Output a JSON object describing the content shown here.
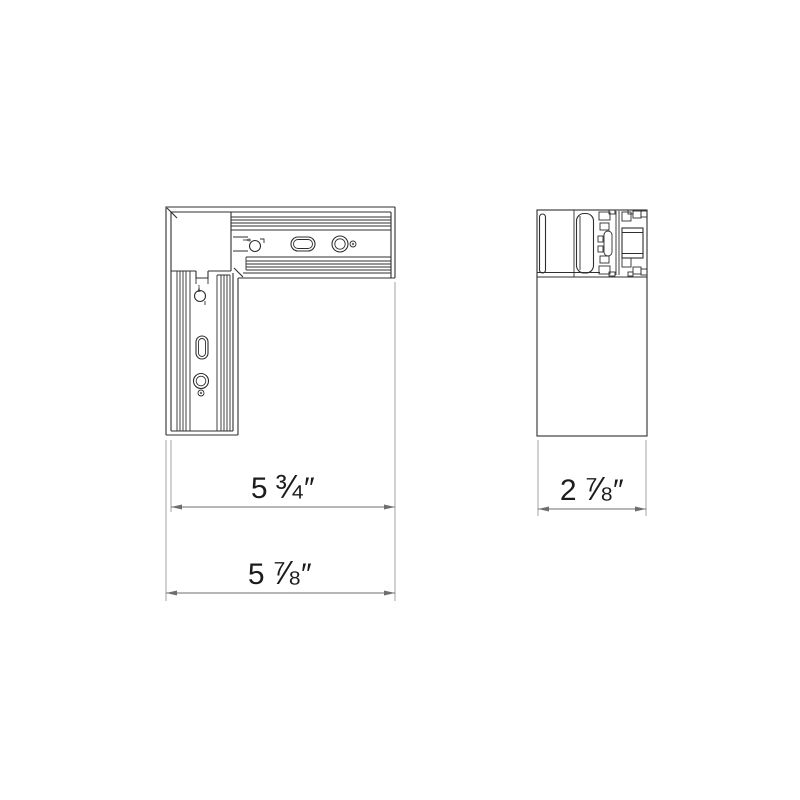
{
  "drawing": {
    "colors": {
      "line": "#2f2f2f",
      "dim": "#6e6e6e",
      "ext": "#9a9a9a",
      "text": "#1c1c1c",
      "bg": "#ffffff"
    },
    "dimensions": [
      {
        "id": "plan-inner-width",
        "whole": "5",
        "fraction": "¾",
        "unit": "″"
      },
      {
        "id": "plan-overall-width",
        "whole": "5",
        "fraction": "⅞",
        "unit": "″"
      },
      {
        "id": "side-width",
        "whole": "2",
        "fraction": "⅞",
        "unit": "″"
      }
    ]
  }
}
